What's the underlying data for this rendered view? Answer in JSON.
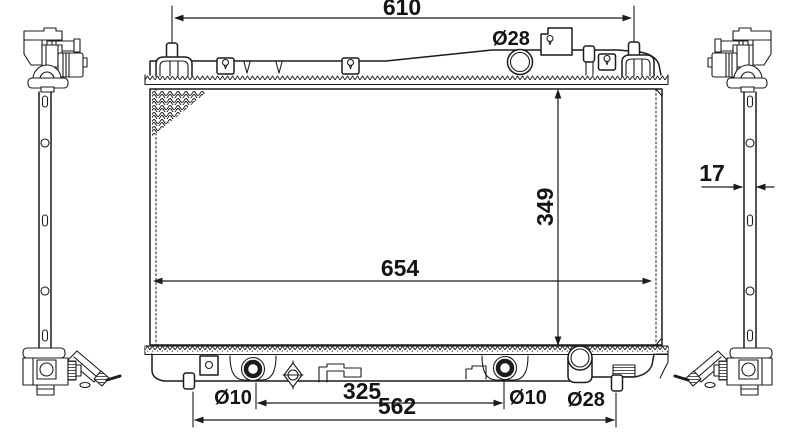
{
  "colors": {
    "line": "#1c1c1c",
    "background": "#ffffff"
  },
  "drawing_type": "radiator-technical-drawing",
  "dimensions": {
    "top_mounting_width": "610",
    "filler_neck_diameter": "Ø28",
    "core_height": "349",
    "core_width": "654",
    "core_thickness": "17",
    "left_grommet_diameter": "Ø10",
    "grommet_spacing": "325",
    "mount_pin_spacing": "562",
    "right_grommet_diameter": "Ø10",
    "outlet_diameter": "Ø28"
  }
}
